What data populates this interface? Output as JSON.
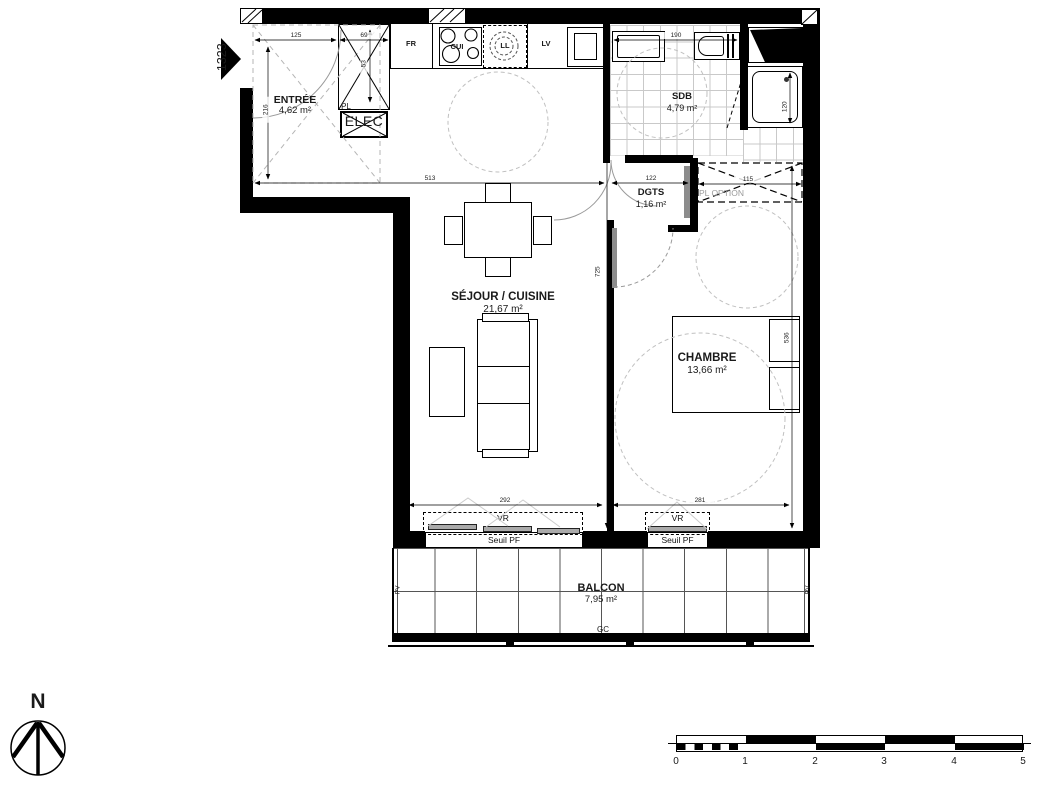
{
  "plan": {
    "code": "1323"
  },
  "rooms": {
    "entree": {
      "name": "ENTRÉE",
      "area": "4,62 m²"
    },
    "sdb": {
      "name": "SDB",
      "area": "4,79 m²"
    },
    "dgts": {
      "name": "DGTS",
      "area": "1,16 m²"
    },
    "sejour": {
      "name": "SÉJOUR / CUISINE",
      "area": "21,67 m²"
    },
    "chambre": {
      "name": "CHAMBRE",
      "area": "13,66 m²"
    },
    "balcon": {
      "name": "BALCON",
      "area": "7,95 m²"
    }
  },
  "fixtures": {
    "fr": "FR",
    "cui": "CUI",
    "ll": "LL",
    "lv": "LV",
    "pl": "PL",
    "elec": "ELEC",
    "pl_option": "PL OPTION"
  },
  "windows": {
    "vr": "VR",
    "seuil": "Seuil PF",
    "pv": "PV",
    "gc": "GC"
  },
  "dims": {
    "d125": "125",
    "d69": "69",
    "d190": "190",
    "d513": "513",
    "d122": "122",
    "d115": "115",
    "d292": "292",
    "d281": "281",
    "d216": "216",
    "d53": "53",
    "d725": "725",
    "d536": "536",
    "d120": "120"
  },
  "compass": {
    "north": "N"
  },
  "scalebar": {
    "labels": [
      "0",
      "1",
      "2",
      "3",
      "4",
      "5"
    ]
  }
}
